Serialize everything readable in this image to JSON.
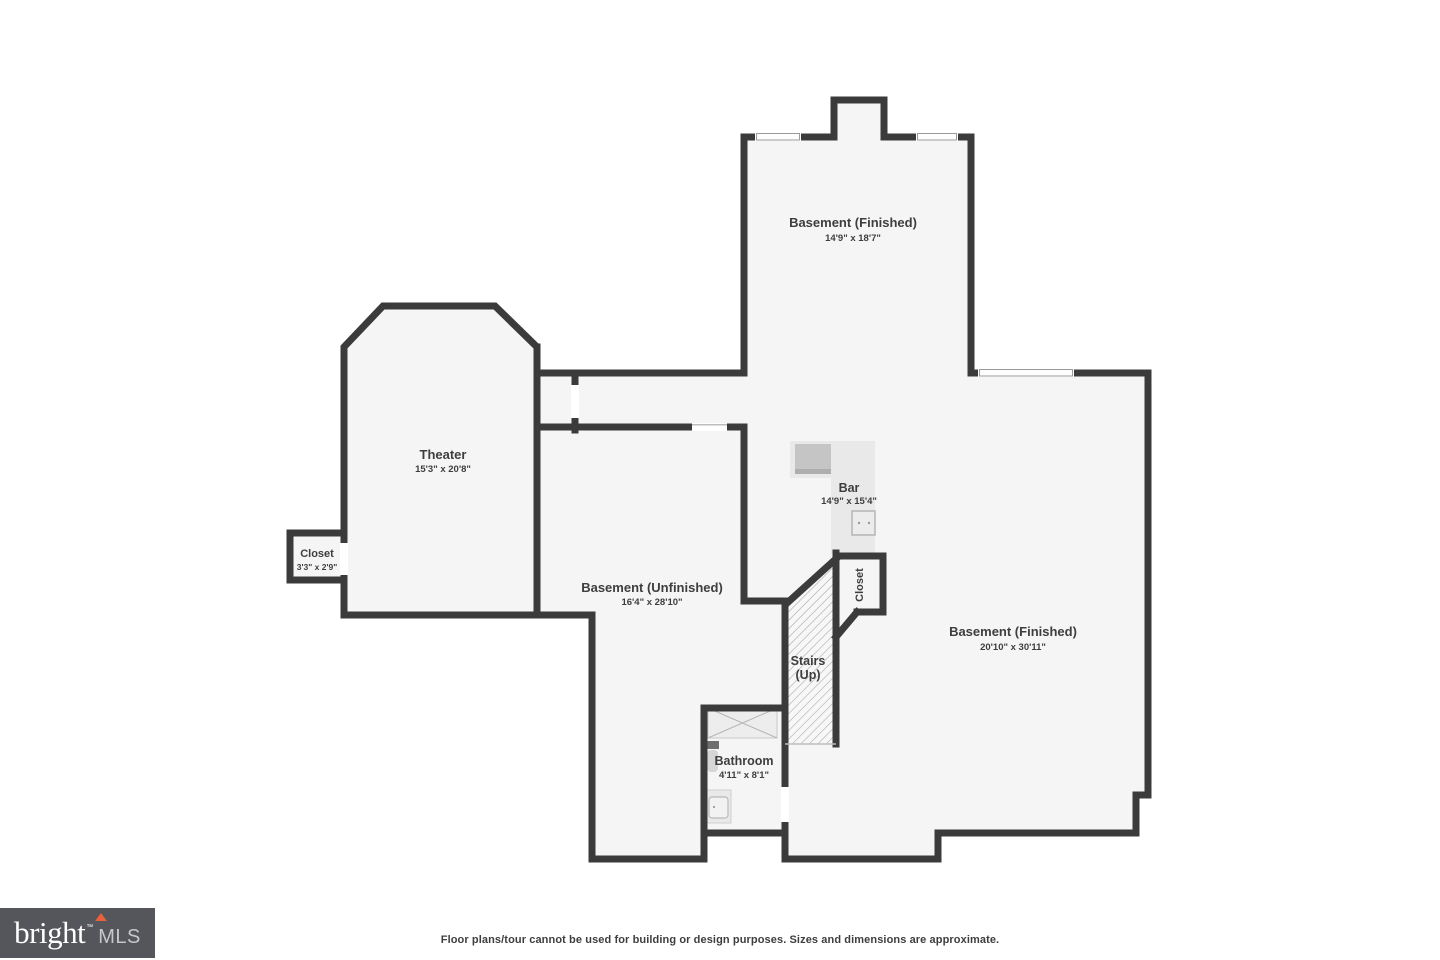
{
  "floorplan": {
    "rooms": {
      "basement_top": {
        "name": "Basement (Finished)",
        "dims": "14'9\" x 18'7\""
      },
      "theater": {
        "name": "Theater",
        "dims": "15'3\" x 20'8\""
      },
      "closet_left": {
        "name": "Closet",
        "dims": "3'3\" x 2'9\""
      },
      "basement_unfinished": {
        "name": "Basement (Unfinished)",
        "dims": "16'4\" x 28'10\""
      },
      "bar": {
        "name": "Bar",
        "dims": "14'9\" x 15'4\""
      },
      "stairs": {
        "name": "Stairs",
        "dims": "(Up)"
      },
      "closet_stairs": {
        "name": "Closet"
      },
      "bathroom": {
        "name": "Bathroom",
        "dims": "4'11\" x 8'1\""
      },
      "basement_right": {
        "name": "Basement (Finished)",
        "dims": "20'10\" x 30'11\""
      }
    },
    "colors": {
      "wall": "#3b3b3b",
      "room_fill": "#f5f5f5",
      "counter": "#e9e9e9",
      "appliance": "#c5c5c5",
      "hatch_line": "#a3a3a3",
      "label_text": "#3e3e3e"
    }
  },
  "footer": {
    "logo_text": "bright",
    "logo_trademark": "™",
    "logo_suffix": "MLS",
    "disclaimer": "Floor plans/tour cannot be used for building or design purposes. Sizes and dimensions are approximate."
  }
}
